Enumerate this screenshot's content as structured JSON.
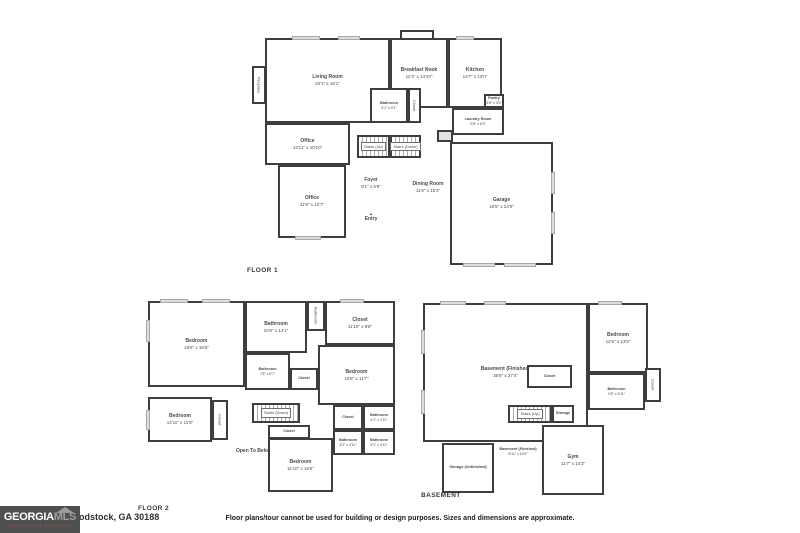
{
  "meta": {
    "disclaimer": "Floor plans/tour cannot be used for building or design purposes. Sizes and dimensions are approximate.",
    "address_visible": "odstock, GA 30188",
    "logo": {
      "brand_a": "GEORGIA",
      "brand_b": "MLS",
      "tagline": "REAL ESTATE SERVICES"
    },
    "icons": {
      "entry_arrow": "▲"
    },
    "wall_color": "#3e3e3e",
    "text_color": "#4a4a4a"
  },
  "floor1": {
    "label": "FLOOR 1",
    "rooms": {
      "fireplace": {
        "name": "Fireplace"
      },
      "living": {
        "name": "Living Room",
        "dims": "20'1\" x 16'1\""
      },
      "breakfast": {
        "name": "Breakfast Nook",
        "dims": "11'3\" x 14'10\""
      },
      "kitchen": {
        "name": "Kitchen",
        "dims": "13'7\" x 13'0\""
      },
      "bathroom": {
        "name": "Bathroom",
        "dims": "5'1\" x 5'1\""
      },
      "closet": {
        "name": "Closet"
      },
      "pantry": {
        "name": "Pantry",
        "dims": "5'6\" x 3'9\""
      },
      "laundry": {
        "name": "Laundry Room",
        "dims": "9'8\" x 6'3\""
      },
      "stairs_up": {
        "name": "Stairs (Up)"
      },
      "stairs_down": {
        "name": "Stairs (Down)"
      },
      "office1": {
        "name": "Office",
        "dims": "14'11\" x 10'10\""
      },
      "office2": {
        "name": "Office",
        "dims": "11'8\" x 12'7\""
      },
      "foyer": {
        "name": "Foyer",
        "dims": "9'1\" x 6'9\""
      },
      "dining": {
        "name": "Dining Room",
        "dims": "11'8\" x 15'2\""
      },
      "entry": {
        "name": "Entry"
      },
      "garage": {
        "name": "Garage",
        "dims": "19'5\" x 24'0\""
      }
    }
  },
  "floor2": {
    "label": "FLOOR 2",
    "rooms": {
      "bedroom1": {
        "name": "Bedroom",
        "dims": "19'6\" x 16'6\""
      },
      "bathroom1": {
        "name": "Bathroom",
        "dims": "10'6\" x 14'1\""
      },
      "bathroom_small": {
        "name": "Bathroom"
      },
      "closet1": {
        "name": "Closet",
        "dims": "11'10\" x 8'8\""
      },
      "bathroom2": {
        "name": "Bathroom",
        "dims": "7'6\" x 6'7\""
      },
      "closet2": {
        "name": "Closet"
      },
      "bedroom2": {
        "name": "Bedroom",
        "dims": "15'8\" x 11'7\""
      },
      "bedroom3": {
        "name": "Bedroom",
        "dims": "14'11\" x 11'8\""
      },
      "closet3": {
        "name": "Closet"
      },
      "stairs_down": {
        "name": "Stairs (Down)"
      },
      "closet4": {
        "name": "Closet"
      },
      "open_below": {
        "name": "Open To Below"
      },
      "closet5": {
        "name": "Closet"
      },
      "bathroom3": {
        "name": "Bathroom",
        "dims": "5'1\" x 4'11\""
      },
      "bathroom4": {
        "name": "Bathroom",
        "dims": "5'2\" x 4'11\""
      },
      "bathroom5": {
        "name": "Bathroom",
        "dims": "5'1\" x 4'11\""
      },
      "bedroom4": {
        "name": "Bedroom",
        "dims": "11'10\" x 15'6\""
      }
    }
  },
  "basement": {
    "label": "BASEMENT",
    "rooms": {
      "main": {
        "name": "Basement (Finished)",
        "dims": "36'8\" x 27'4\""
      },
      "closet1": {
        "name": "Closet"
      },
      "bedroom": {
        "name": "Bedroom",
        "dims": "12'6\" x 13'5\""
      },
      "bathroom": {
        "name": "Bathroom",
        "dims": "9'8\" x 5'11\""
      },
      "closet2": {
        "name": "Closet"
      },
      "stairs_up": {
        "name": "Stairs (Up)"
      },
      "storage1": {
        "name": "Storage"
      },
      "finished2": {
        "name": "Basement (Finished)",
        "dims": "8'11\" x 14'0\""
      },
      "storage2": {
        "name": "Storage (Unfinished)"
      },
      "gym": {
        "name": "Gym",
        "dims": "11'7\" x 14'3\""
      }
    }
  }
}
